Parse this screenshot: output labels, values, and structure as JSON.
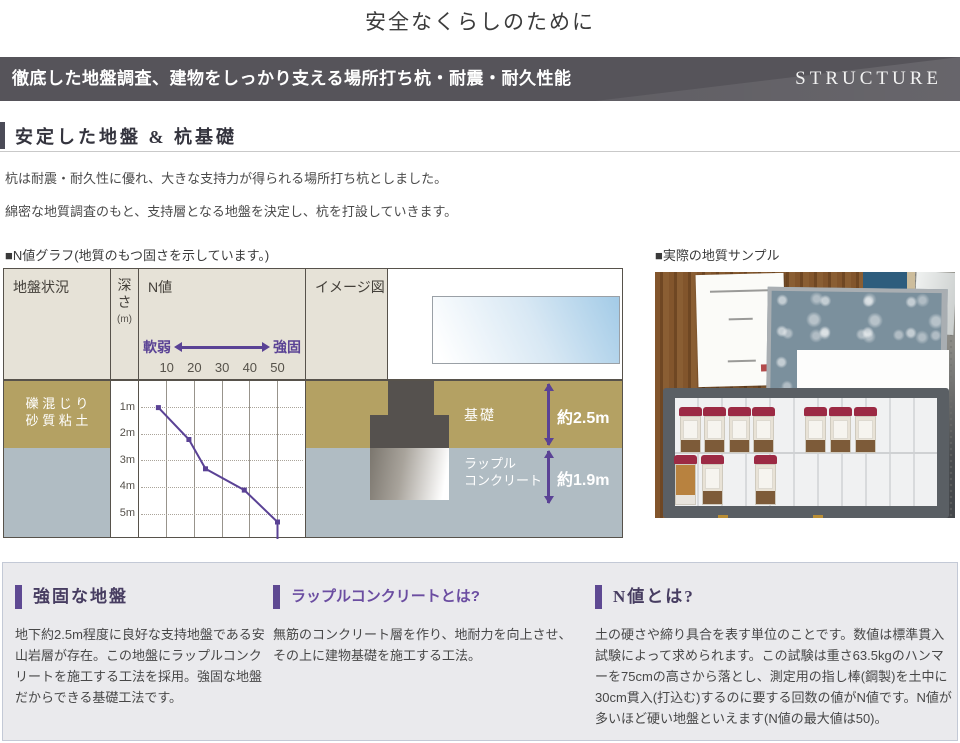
{
  "page": {
    "title": "安全なくらしのために"
  },
  "banner": {
    "text": "徹底した地盤調査、建物をしっかり支える場所打ち杭・耐震・耐久性能",
    "en": "STRUCTURE",
    "bg_color": "#56545a"
  },
  "section": {
    "heading": "安定した地盤 & 杭基礎",
    "intro": [
      "杭は耐震・耐久性に優れ、大きな支持力が得られる場所打ち杭としました。",
      "綿密な地質調査のもと、支持層となる地盤を決定し、杭を打設していきます。"
    ]
  },
  "graph": {
    "label": "■N値グラフ(地質のもつ固さを示しています。)",
    "columns": {
      "ground": "地盤状況",
      "depth": [
        "深",
        "さ",
        "(m)"
      ],
      "nvalue": "N値",
      "image": "イメージ図"
    },
    "scale": {
      "soft": "軟弱",
      "firm": "強固"
    },
    "layers": [
      {
        "line1": "礫 混 じ り",
        "line2": "砂 質 粘 土",
        "color": "#b4a163"
      },
      {
        "line1": "風化安山岩",
        "color": "#b0bcc3"
      }
    ],
    "image_labels": {
      "foundation": "基礎",
      "rubble_1": "ラップル",
      "rubble_2": "コンクリート",
      "dim_upper": "約2.5m",
      "dim_lower": "約1.9m"
    }
  },
  "chart_data": {
    "type": "line",
    "title": "N値グラフ(地質のもつ固さを示しています。)",
    "x_axis": {
      "soft_label": "軟弱",
      "firm_label": "強固",
      "ticks": [
        10,
        20,
        30,
        40,
        50
      ],
      "range": [
        0,
        60
      ]
    },
    "y_axis": {
      "label": "深さ(m)",
      "tick_labels": [
        "1m",
        "2m",
        "3m",
        "4m",
        "5m"
      ],
      "range_m": [
        0,
        6
      ],
      "direction": "down"
    },
    "series": [
      {
        "name": "N値",
        "points": [
          {
            "depth_m": 1.0,
            "n": 7
          },
          {
            "depth_m": 2.2,
            "n": 18
          },
          {
            "depth_m": 3.3,
            "n": 24
          },
          {
            "depth_m": 4.1,
            "n": 38
          },
          {
            "depth_m": 5.3,
            "n": 50
          }
        ]
      }
    ],
    "terminal_drop_n": 50,
    "line_color": "#5a4295",
    "grid": true
  },
  "sample": {
    "label": "■実際の地質サンプル"
  },
  "photo": {
    "bottle_rows": [
      {
        "top": 9,
        "height": 46,
        "x": [
          5,
          29,
          54,
          78,
          130,
          155,
          180
        ],
        "variants": [
          "",
          "",
          "",
          "",
          "",
          "",
          ""
        ]
      },
      {
        "top": 57,
        "height": 50,
        "x": [
          0,
          27,
          80
        ],
        "variants": [
          "orange",
          "",
          ""
        ]
      }
    ],
    "cap_color": "#9c2a44"
  },
  "info_columns": [
    {
      "heading": "強固な地盤",
      "style": "serif",
      "body": "地下約2.5m程度に良好な支持地盤である安山岩層が存在。この地盤にラップルコンクリートを施工する工法を採用。強固な地盤だからできる基礎工法です。"
    },
    {
      "heading": "ラップルコンクリートとは?",
      "style": "sans",
      "body": "無筋のコンクリート層を作り、地耐力を向上させ、その上に建物基礎を施工する工法。"
    },
    {
      "heading": "N値とは?",
      "style": "serif",
      "body": "土の硬さや締り具合を表す単位のことです。数値は標準貫入試験によって求められます。この試験は重さ63.5kgのハンマーを75cmの高さから落とし、測定用の指し棒(鋼製)を土中に30cm貫入(打込む)するのに要する回数の値がN値です。N値が多いほど硬い地盤といえます(N値の最大値は50)。"
    }
  ],
  "colors": {
    "accent_purple": "#5a4295",
    "layer_tan": "#b4a163",
    "layer_gray_blue": "#b0bcc3",
    "header_beige": "#e6e2d7",
    "foundation_dark": "#55514e"
  }
}
